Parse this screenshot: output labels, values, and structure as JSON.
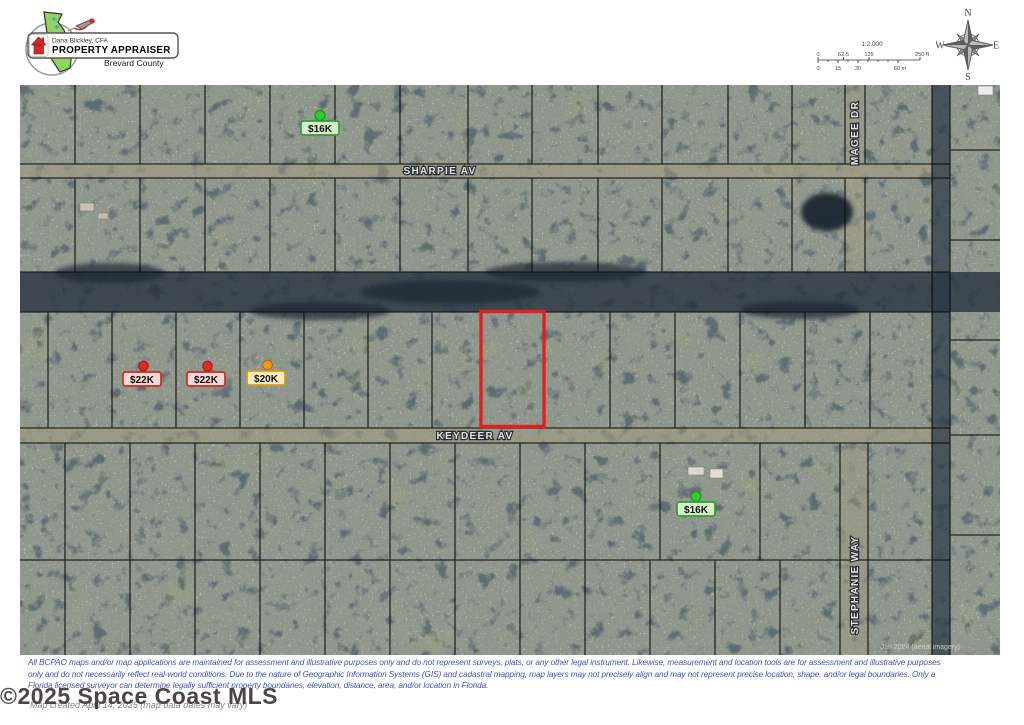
{
  "header": {
    "logo": {
      "name_line": "Dana Blickley, CFA",
      "title_line": "PROPERTY APPRAISER",
      "county_line": "Brevard County"
    },
    "scale_bar": {
      "ratio_label": "1:2,000",
      "feet_ticks": [
        "0",
        "62.5",
        "125",
        "250 ft"
      ],
      "meter_ticks": [
        "0",
        "15",
        "30",
        "60 m"
      ]
    },
    "compass": {
      "north": "N",
      "east": "E",
      "south": "S",
      "west": "W"
    }
  },
  "map": {
    "streets": [
      {
        "label": "SHARPIE AV"
      },
      {
        "label": "KEYDEER AV"
      },
      {
        "label": "MAGEE DR"
      },
      {
        "label": "STEPHANIE WAY"
      }
    ],
    "markers": [
      {
        "label": "$16K",
        "pin": "#2ecc2e",
        "pin_dark": "#1e8a1e",
        "bg": "#d6f1c9",
        "border": "#2e9e2e"
      },
      {
        "label": "$22K",
        "pin": "#e8281e",
        "pin_dark": "#9c1810",
        "bg": "#f6d8d4",
        "border": "#cc2a22"
      },
      {
        "label": "$22K",
        "pin": "#e8281e",
        "pin_dark": "#9c1810",
        "bg": "#f6d8d4",
        "border": "#cc2a22"
      },
      {
        "label": "$20K",
        "pin": "#f09a18",
        "pin_dark": "#a96708",
        "bg": "#faeabc",
        "border": "#d79a20"
      },
      {
        "label": "$16K",
        "pin": "#2ecc2e",
        "pin_dark": "#1e8a1e",
        "bg": "#d6f1c9",
        "border": "#2e9e2e"
      }
    ],
    "highlight": {
      "color": "#e31f1f"
    },
    "imagery_credit": "Jan 2024 (aerial imagery)"
  },
  "footer": {
    "disclaimer_line1": "All BCPAO maps and/or map applications are maintained for assessment and illustrative purposes only and do not represent surveys, plats, or any other legal instrument. Likewise, measurement and location tools are for assessment and illustrative purposes",
    "disclaimer_line2": "only and do not necessarily reflect real-world conditions. Due to the nature of Geographic Information Systems (GIS) and cadastral mapping, map layers may not precisely align and may not represent precise location, shape, and/or legal boundaries. Only a",
    "disclaimer_line3": "Florida licensed surveyor can determine legally sufficient property boundaries, elevation, distance, area, and/or location in Florida.",
    "created_line": "Map created April 14, 2025 (map data dates may vary)",
    "watermark": "©2025 Space Coast MLS",
    "disclaimer_color": "#3a56c4"
  }
}
